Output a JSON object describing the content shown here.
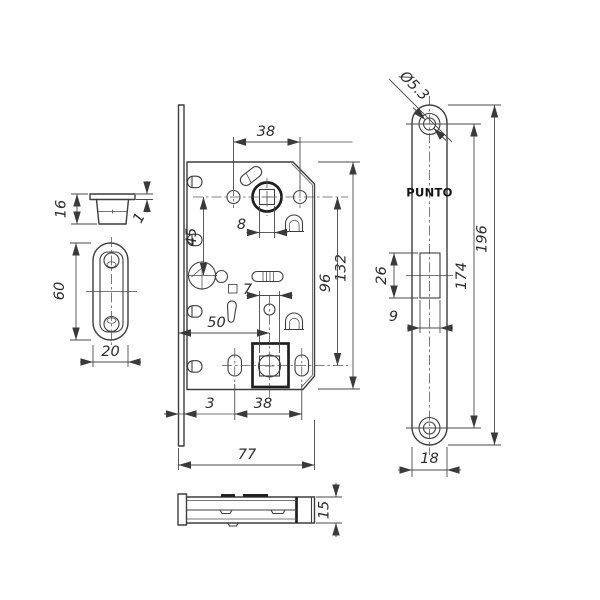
{
  "brand": {
    "label": "PUNTO"
  },
  "dims": {
    "top_spacing": "38",
    "spindle_offset": "45",
    "spindle_square": "8",
    "wc_square": "7",
    "backset": "50",
    "centers": "96",
    "body_height": "132",
    "plate_thickness": "3",
    "bottom_spacing": "38",
    "body_width": "77",
    "cap_height": "16",
    "cap_flange": "1",
    "strike_height": "60",
    "strike_width": "20",
    "hole_dia": "Ø5.3",
    "latch_height": "26",
    "latch_width": "9",
    "screw_centers": "174",
    "plate_height": "196",
    "plate_width": "18",
    "body_depth": "15"
  }
}
